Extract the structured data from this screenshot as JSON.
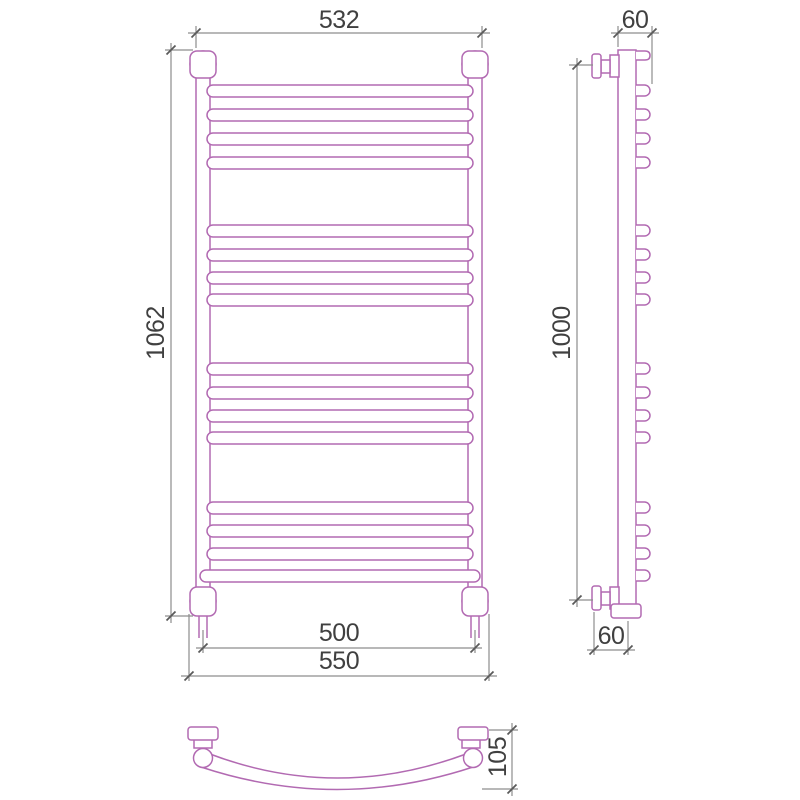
{
  "page": {
    "background": "#ffffff"
  },
  "drawing": {
    "type": "technical-dimension-drawing",
    "subject": "ladder-towel-rail-radiator",
    "colors": {
      "outline": "#b26ab2",
      "dimension_lines": "#8d8d8d",
      "dimension_text": "#404040",
      "background": "#ffffff"
    },
    "front_view": {
      "width_top": "532",
      "height_overall": "1062",
      "width_connections": "500",
      "width_overall": "550"
    },
    "side_view": {
      "depth_top": "60",
      "height_mounting": "1000",
      "depth_bottom": "60"
    },
    "bottom_view": {
      "depth_overall": "105"
    }
  }
}
